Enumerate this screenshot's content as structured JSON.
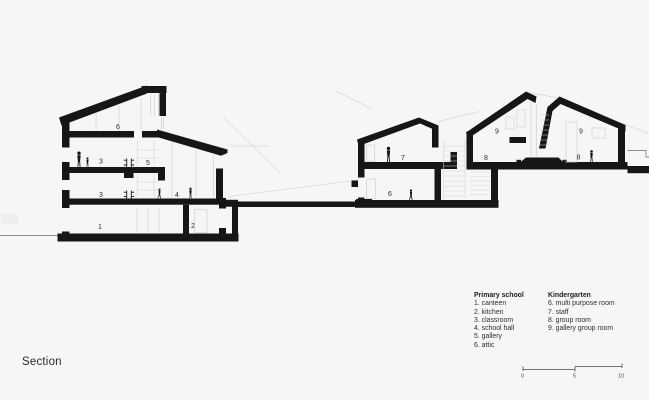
{
  "page": {
    "title": "Section"
  },
  "colors": {
    "background": "#f6f6f4",
    "ink": "#161616"
  },
  "legend": {
    "primary_school": {
      "heading": "Primary school",
      "items": [
        "1. canteen",
        "2. kitchen",
        "3. classroom",
        "4. school hall",
        "5. gallery",
        "6. attic"
      ]
    },
    "kindergarten": {
      "heading": "Kindergarten",
      "items": [
        "6. multi purpose room",
        "7. staff",
        "8. group room",
        "9. gallery group room"
      ]
    }
  },
  "drawing": {
    "room_labels": [
      {
        "building": "primary-school",
        "room": "attic",
        "t": "6"
      },
      {
        "building": "primary-school",
        "room": "classroom-upper",
        "t": "3"
      },
      {
        "building": "primary-school",
        "room": "gallery",
        "t": "5"
      },
      {
        "building": "primary-school",
        "room": "classroom-lower",
        "t": "3"
      },
      {
        "building": "primary-school",
        "room": "school-hall",
        "t": "4"
      },
      {
        "building": "primary-school",
        "room": "canteen",
        "t": "1"
      },
      {
        "building": "primary-school",
        "room": "kitchen",
        "t": "2"
      },
      {
        "building": "kindergarten",
        "room": "staff",
        "t": "7"
      },
      {
        "building": "kindergarten",
        "room": "multi-purpose-room",
        "t": "6"
      },
      {
        "building": "kindergarten",
        "room": "gallery-group-room-left",
        "t": "9"
      },
      {
        "building": "kindergarten",
        "room": "group-room-left",
        "t": "8"
      },
      {
        "building": "kindergarten",
        "room": "gallery-group-room-right",
        "t": "9"
      },
      {
        "building": "kindergarten",
        "room": "group-room-right",
        "t": "8"
      }
    ],
    "scale_bar": {
      "ticks": [
        "0",
        "5",
        "10"
      ]
    }
  }
}
